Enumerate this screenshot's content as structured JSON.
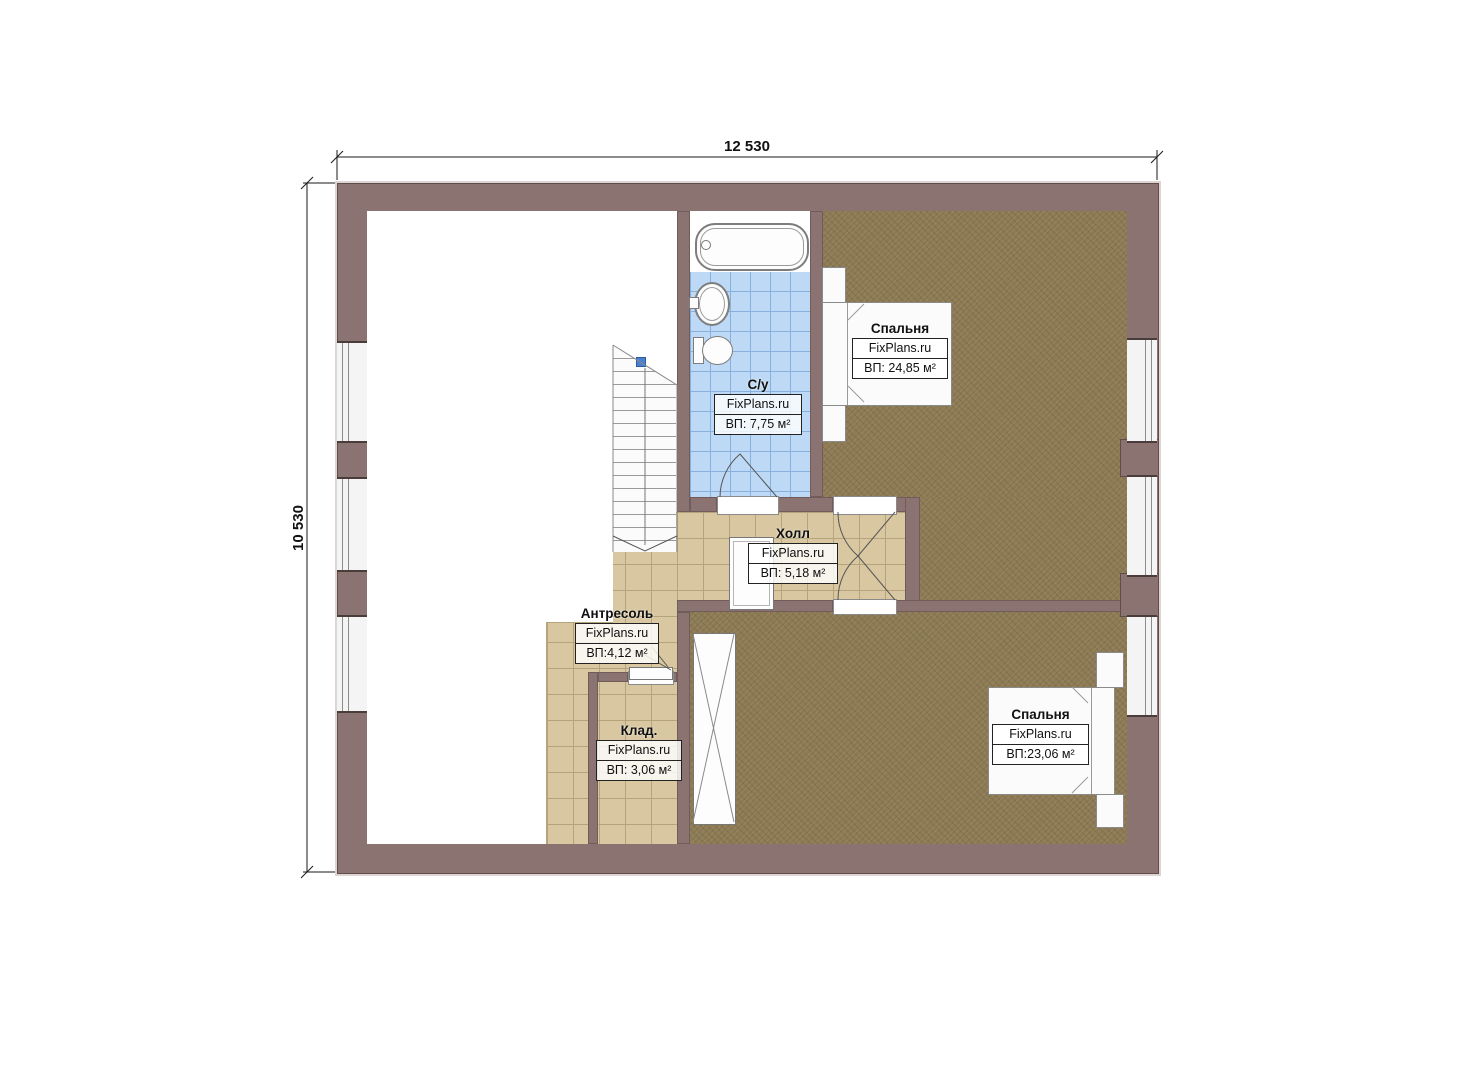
{
  "dimensions": {
    "width_label": "12 530",
    "height_label": "10 530"
  },
  "rooms": [
    {
      "id": "bedroom-top",
      "name": "Спальня",
      "source": "FixPlans.ru",
      "area": "ВП: 24,85 м²"
    },
    {
      "id": "bathroom",
      "name": "С/у",
      "source": "FixPlans.ru",
      "area": "ВП: 7,75 м²"
    },
    {
      "id": "hall",
      "name": "Холл",
      "source": "FixPlans.ru",
      "area": "ВП: 5,18 м²"
    },
    {
      "id": "mezzanine",
      "name": "Антресоль",
      "source": "FixPlans.ru",
      "area": "ВП:4,12 м²"
    },
    {
      "id": "storage",
      "name": "Клад.",
      "source": "FixPlans.ru",
      "area": "ВП: 3,06 м²"
    },
    {
      "id": "bedroom-bottom",
      "name": "Спальня",
      "source": "FixPlans.ru",
      "area": "ВП:23,06 м²"
    }
  ],
  "colors": {
    "wall": "#8b7372",
    "wall_edge": "#5f4c4b",
    "tan": "#d8c7a0",
    "tan_line": "#b4a37b",
    "blue": "#bdd9f5",
    "blue_line": "#88b0dd",
    "carpet": "#8c7a54",
    "window_fill": "#f4f4f4",
    "marker": "#4d7fcf"
  }
}
